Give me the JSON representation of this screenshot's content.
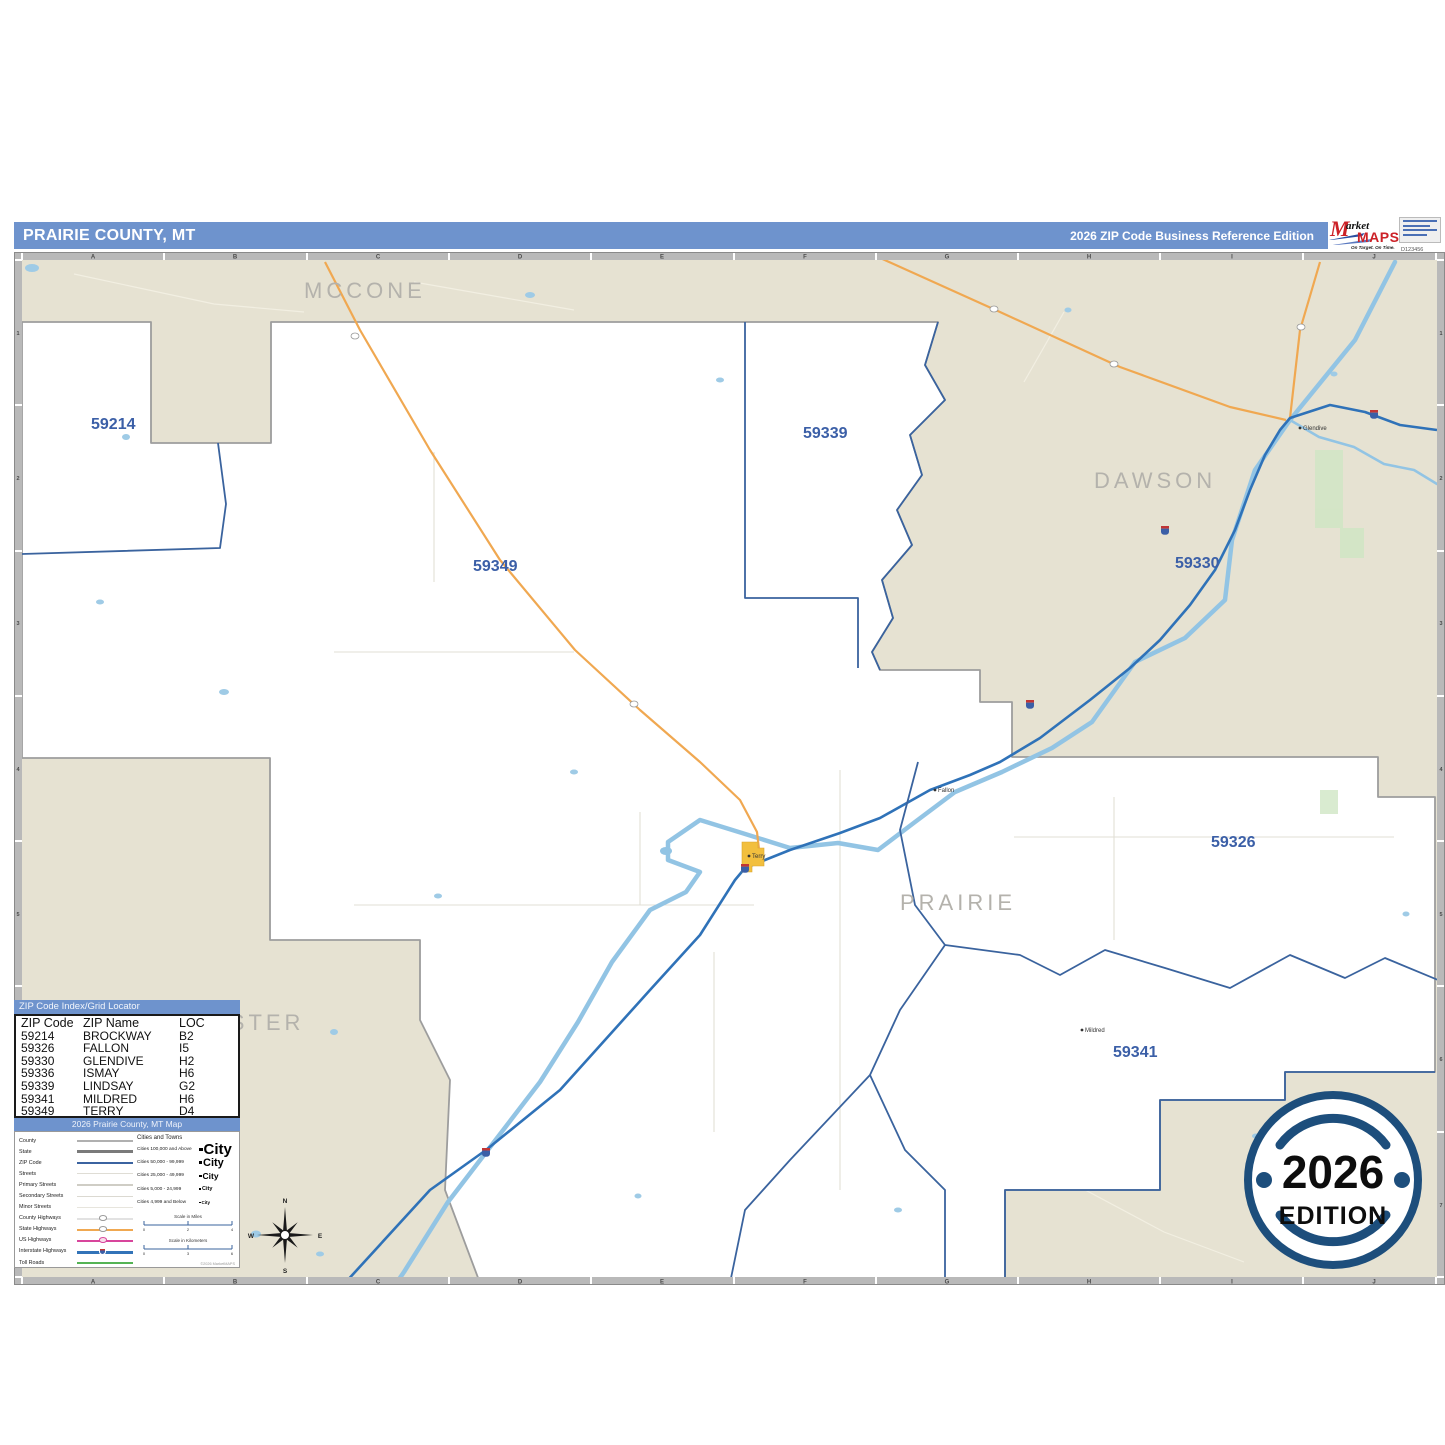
{
  "header": {
    "title": "PRAIRIE COUNTY, MT",
    "subtitle": "2026 ZIP Code Business Reference Edition"
  },
  "logo": {
    "m": "M",
    "rest": "arket",
    "maps": "MAPS",
    "tagline": "On Target. On Time.",
    "subline": "America's Leading Source of Business Maps",
    "code": "D123456"
  },
  "grid": {
    "cols": [
      "A",
      "B",
      "C",
      "D",
      "E",
      "F",
      "G",
      "H",
      "I",
      "J"
    ],
    "rows": [
      "1",
      "2",
      "3",
      "4",
      "5",
      "6",
      "7"
    ]
  },
  "map": {
    "counties": {
      "mccone": "MCCONE",
      "dawson": "DAWSON",
      "prairie": "PRAIRIE",
      "custer": "CUSTER"
    },
    "zips": {
      "z59214": "59214",
      "z59339": "59339",
      "z59349": "59349",
      "z59330": "59330",
      "z59326": "59326",
      "z59341": "59341"
    },
    "towns": {
      "terry": "Terry",
      "fallon": "Fallon",
      "mildred": "Mildred",
      "glendive": "Glendive"
    },
    "compass": {
      "n": "N",
      "e": "E",
      "s": "S",
      "w": "W"
    }
  },
  "index": {
    "title": "ZIP Code Index/Grid Locator",
    "columns": [
      "ZIP Code",
      "ZIP Name",
      "LOC"
    ],
    "rows": [
      {
        "zip": "59214",
        "name": "BROCKWAY",
        "loc": "B2"
      },
      {
        "zip": "59326",
        "name": "FALLON",
        "loc": "I5"
      },
      {
        "zip": "59330",
        "name": "GLENDIVE",
        "loc": "H2"
      },
      {
        "zip": "59336",
        "name": "ISMAY",
        "loc": "H6"
      },
      {
        "zip": "59339",
        "name": "LINDSAY",
        "loc": "G2"
      },
      {
        "zip": "59341",
        "name": "MILDRED",
        "loc": "H6"
      },
      {
        "zip": "59349",
        "name": "TERRY",
        "loc": "D4"
      }
    ]
  },
  "legend": {
    "title": "2026 Prairie County, MT Map",
    "items": [
      "County",
      "State",
      "ZIP Code",
      "Streets",
      "Primary Streets",
      "Secondary Streets",
      "Minor Streets",
      "County Highways",
      "State Highways",
      "US Highways",
      "Interstate Highways",
      "Toll Roads"
    ],
    "cities_title": "Cities and Towns",
    "cities": [
      {
        "label": "Cities 100,000 and Above",
        "sample": "City"
      },
      {
        "label": "Cities 50,000 - 99,999",
        "sample": "City"
      },
      {
        "label": "Cities 25,000 - 49,999",
        "sample": "City"
      },
      {
        "label": "Cities 5,000 - 24,999",
        "sample": "City"
      },
      {
        "label": "Cities 4,999 and Below",
        "sample": "City"
      }
    ],
    "scale_miles": {
      "title": "Scale in Miles",
      "ticks": [
        "0",
        "2",
        "4"
      ]
    },
    "scale_km": {
      "title": "Scale in Kilometers",
      "ticks": [
        "0",
        "3",
        "6"
      ]
    },
    "copyright": "©2026 MarketMAPS"
  },
  "badge": {
    "year": "2026",
    "edition": "EDITION"
  },
  "colors": {
    "header_bg": "#6e93cd",
    "map_tan": "#e6e2d2",
    "zip_label": "#3b5fa7",
    "county_label": "#b4b2ac",
    "zip_line": "#3a639e",
    "county_line": "#9d9d9d",
    "river": "#92c4e4",
    "interstate": "#2f72b8",
    "highway": "#f0a851",
    "badge_navy": "#1d4e7c",
    "town_fill": "#f2bf3e"
  }
}
